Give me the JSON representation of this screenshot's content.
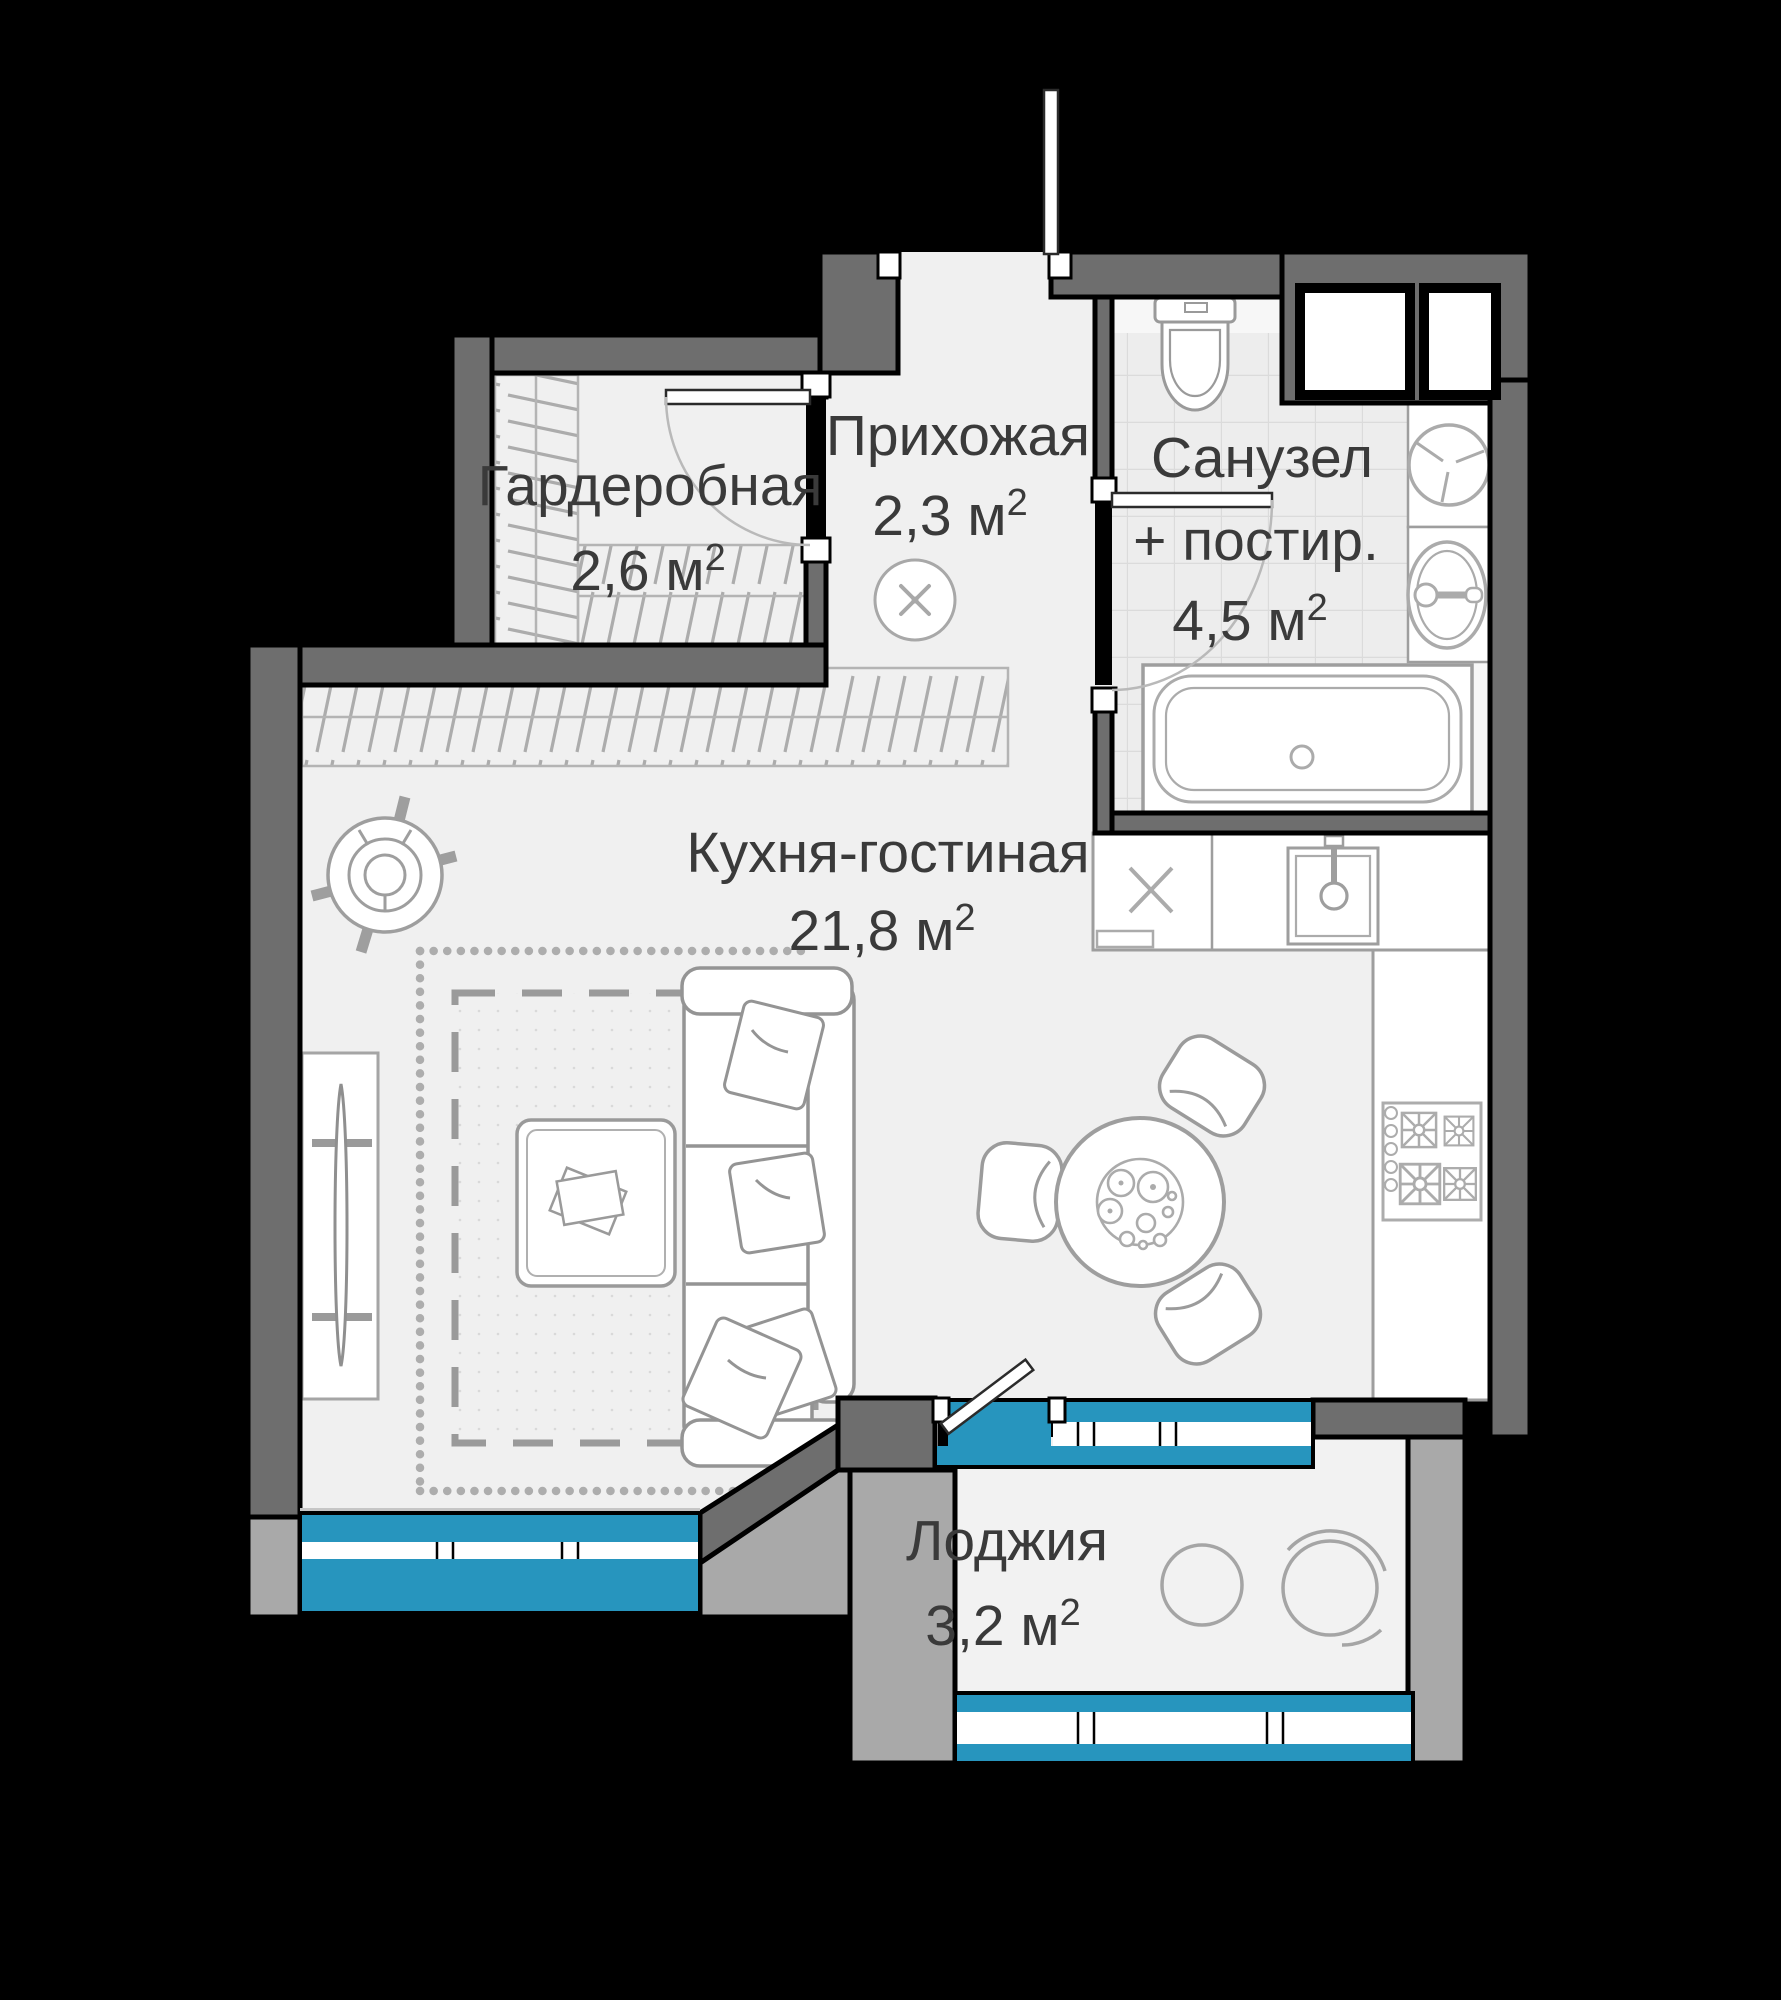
{
  "plan": {
    "title": "Studio apartment floor plan",
    "rooms": [
      {
        "id": "wardrobe",
        "name": "Гардеробная",
        "area": "2,6 м",
        "sup": "2"
      },
      {
        "id": "hallway",
        "name": "Прихожая",
        "area": "2,3 м",
        "sup": "2"
      },
      {
        "id": "bathroom",
        "name": "Санузел",
        "name2": "+ постир.",
        "area": "4,5 м",
        "sup": "2"
      },
      {
        "id": "kitchen-living",
        "name": "Кухня-гостиная",
        "area": "21,8 м",
        "sup": "2"
      },
      {
        "id": "loggia",
        "name": "Лоджия",
        "area": "3,2 м",
        "sup": "2"
      }
    ],
    "colors": {
      "wall_dark": "#6E6E6E",
      "wall_light": "#A9A9A9",
      "window_blue": "#2795BE",
      "floor": "#F0F0F0",
      "tile_floor": "#EDEDED",
      "line_gray": "#9B9B9B",
      "text_color": "#3A3A3A",
      "outline": "#000000",
      "background": "#000000"
    }
  }
}
